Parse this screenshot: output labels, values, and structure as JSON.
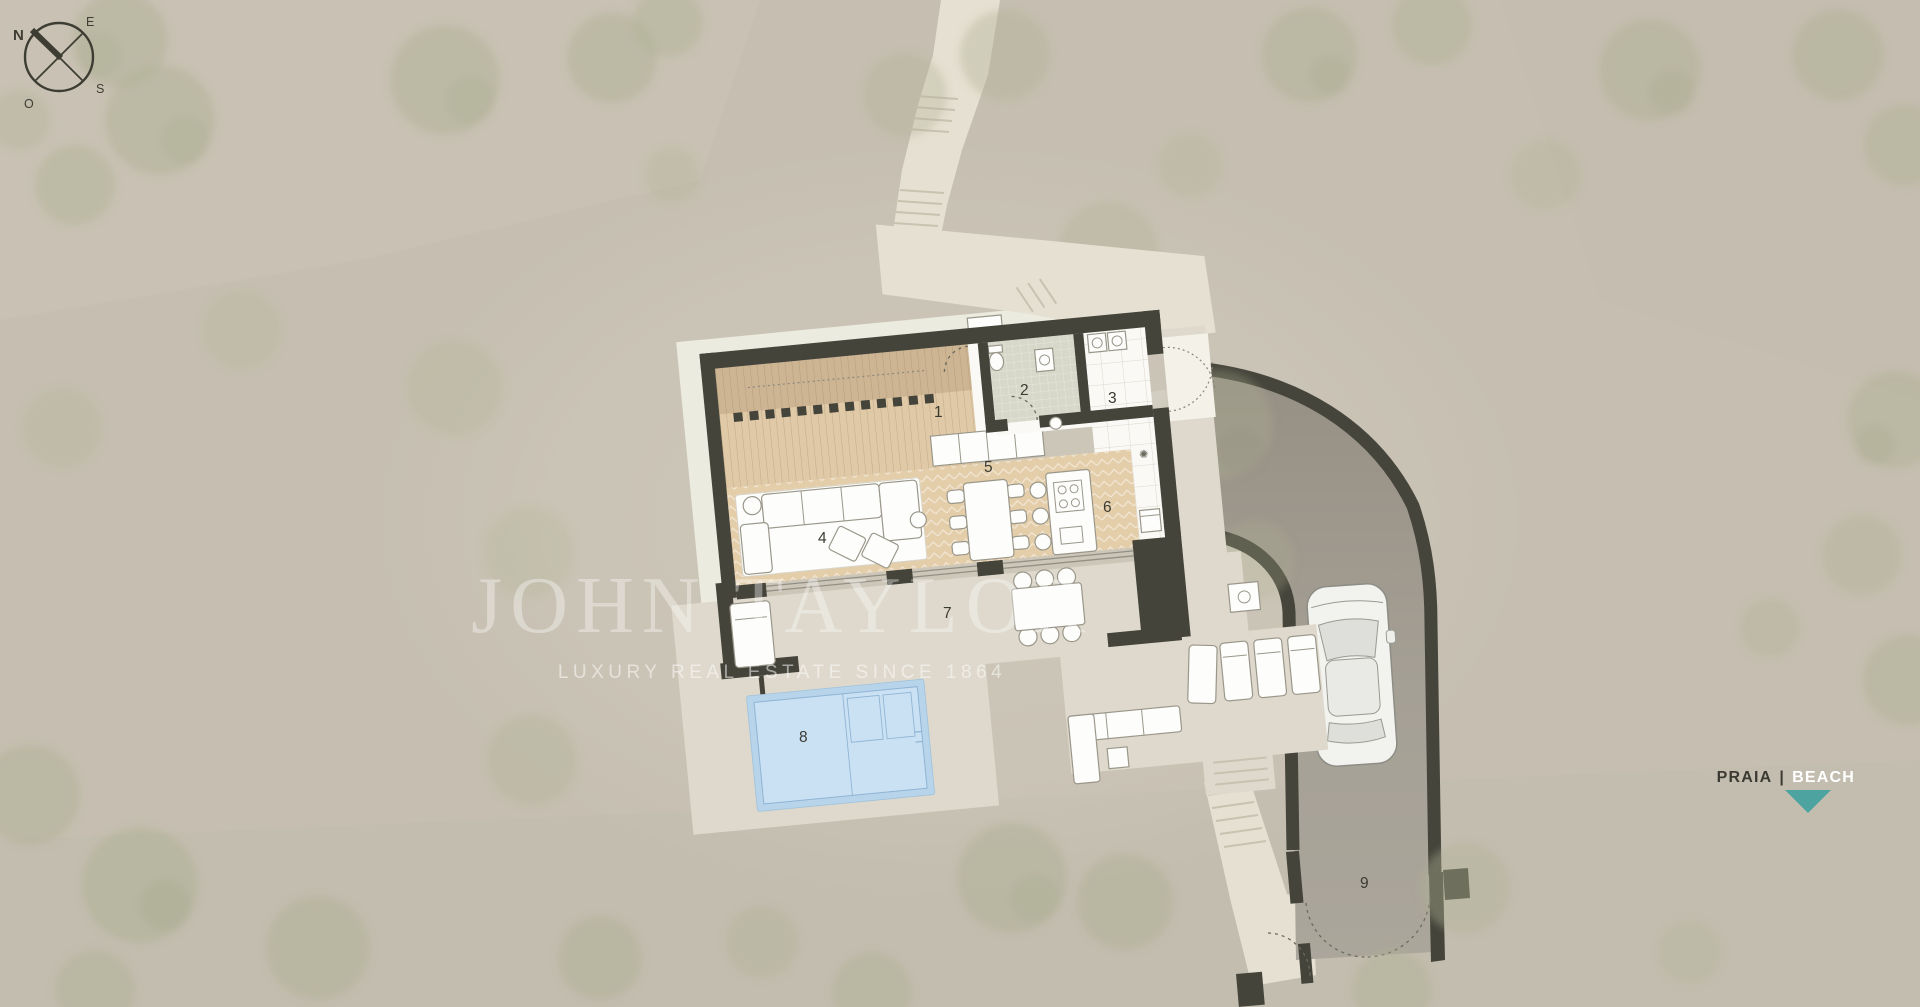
{
  "compass": {
    "north": "N",
    "east": "E",
    "south": "S",
    "west": "O"
  },
  "watermark": {
    "brand": "JOHN TAYLOR",
    "tagline": "LUXURY REAL ESTATE SINCE 1864"
  },
  "location_badge": {
    "left": "PRAIA",
    "separator": "|",
    "right": "BEACH"
  },
  "plan": {
    "room_numbers": [
      "1",
      "2",
      "3",
      "4",
      "5",
      "6",
      "7",
      "8",
      "9"
    ]
  },
  "colors": {
    "terrain": "#c6bfb1",
    "walls": "#45443a",
    "wood_deck": "#e0c9a6",
    "parquet": "#e4cda9",
    "pool_water": "#cae1f3",
    "pool_coping": "#b7d4ea",
    "driveway": "#a5a095",
    "terrace": "#ded9cc",
    "path": "#e6e0d2",
    "accent_teal": "#4da3a0",
    "label": "#3b3a31",
    "watermark": "#ffffff"
  }
}
